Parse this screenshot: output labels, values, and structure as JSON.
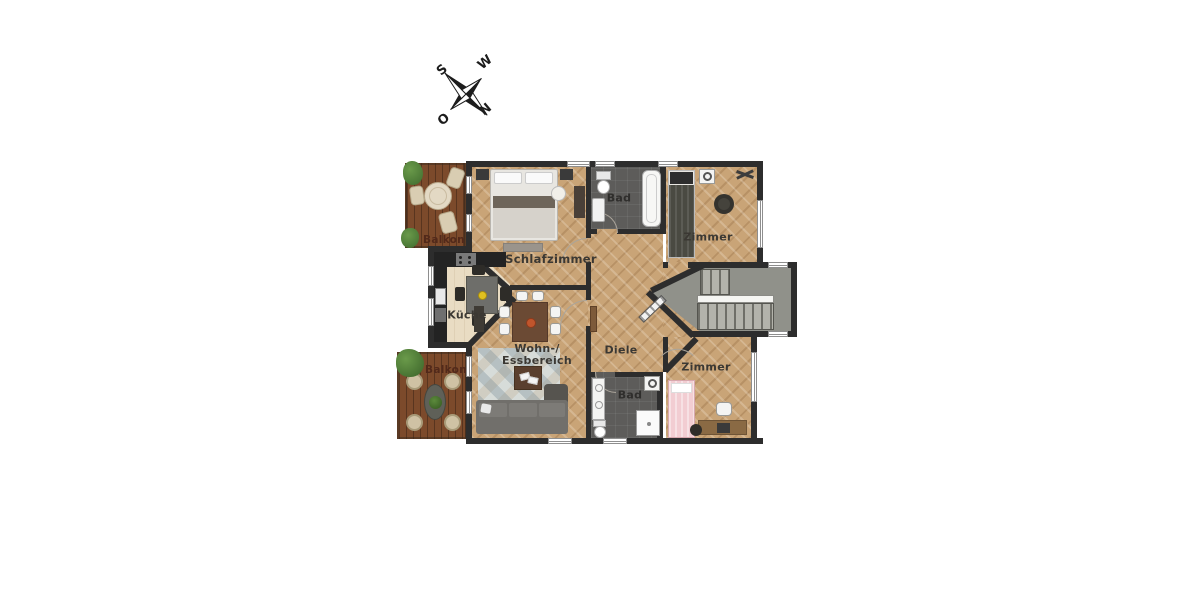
{
  "meta": {
    "type": "apartment-floor-plan",
    "language": "de"
  },
  "compass": {
    "north": "N",
    "east": "O",
    "south": "S",
    "west": "W",
    "rotation_deg": 135
  },
  "rooms": {
    "balkon_top": {
      "label": "Balkon"
    },
    "schlafzimmer": {
      "label": "Schlafzimmer"
    },
    "bad_top": {
      "label": "Bad"
    },
    "zimmer_top": {
      "label": "Zimmer"
    },
    "kueche": {
      "label": "Küche"
    },
    "wohn_essbereich": {
      "label_line1": "Wohn-/",
      "label_line2": "Essbereich"
    },
    "diele": {
      "label": "Diele"
    },
    "zimmer_bottom": {
      "label": "Zimmer"
    },
    "bad_bottom": {
      "label": "Bad"
    },
    "balkon_bottom": {
      "label": "Balkon"
    }
  },
  "colors": {
    "wall": "#2d2d2d",
    "parquet_floor": "#c9a477",
    "kitchen_floor": "#e9dcc3",
    "bath_floor": "#5d5c5a",
    "stair_floor": "#90918a",
    "balcony_deck": "#7c4a2b",
    "room_label_text": "#3b3833",
    "balkon_label_text": "#52291a",
    "bedding_white": "#e8e6e1",
    "pink_bed": "#f2cdd2",
    "sofa_gray": "#716f6b"
  }
}
